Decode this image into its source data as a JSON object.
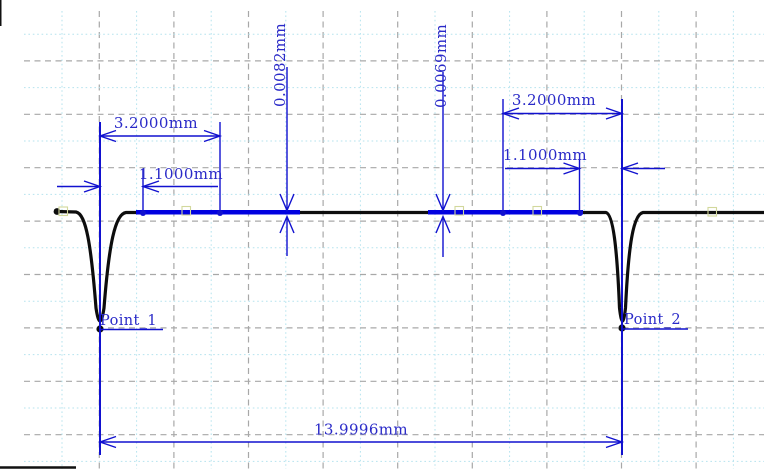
{
  "colors": {
    "background": "#ffffff",
    "grid_minor": "#b5e3ee",
    "grid_major": "#a8a8a8",
    "dimension_line": "#1111cf",
    "dimension_text": "#2a2ac8",
    "profile_line": "#0d0d0d",
    "highlight_segment": "#0000e0",
    "selection_handle": "#d2d89c"
  },
  "points": {
    "point_1": {
      "label": "Point_1"
    },
    "point_2": {
      "label": "Point_2"
    }
  },
  "annotations": {
    "left_width": {
      "label": "3.2000mm",
      "value_mm": 3.2
    },
    "left_offset": {
      "label": "1.1000mm",
      "value_mm": 1.1
    },
    "left_depth": {
      "label": "0.0082mm",
      "value_mm": 0.0082
    },
    "right_depth": {
      "label": "0.0069mm",
      "value_mm": 0.0069
    },
    "right_width": {
      "label": "3.2000mm",
      "value_mm": 3.2
    },
    "right_offset": {
      "label": "1.1000mm",
      "value_mm": 1.1
    },
    "total_width": {
      "label": "13.9996mm",
      "value_mm": 13.9996
    }
  },
  "unit": "mm"
}
